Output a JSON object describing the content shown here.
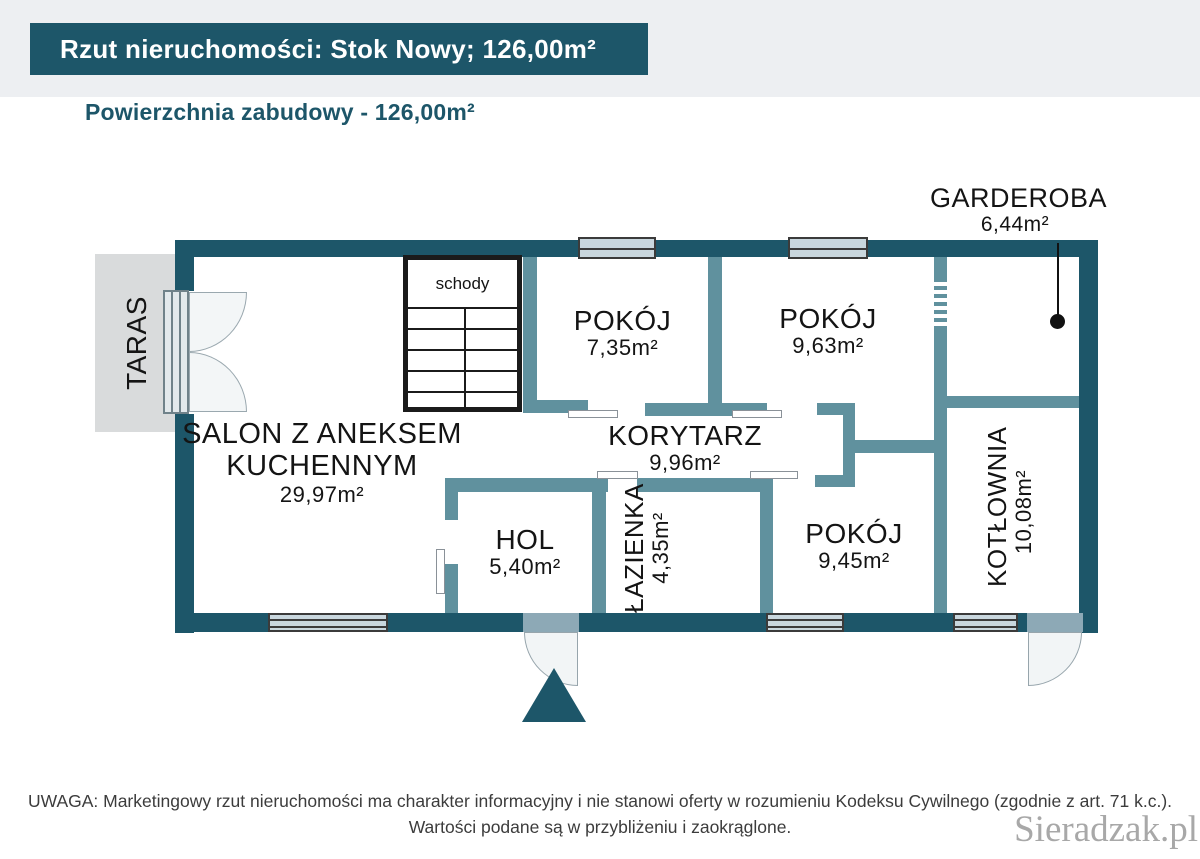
{
  "header": {
    "title": "Rzut nieruchomości: Stok Nowy; 126,00m²"
  },
  "subtitle": "Powierzchnia zabudowy - 126,00m²",
  "rooms": {
    "salon": {
      "line1": "SALON Z ANEKSEM",
      "line2": "KUCHENNYM",
      "area": "29,97m²"
    },
    "pokoj_1": {
      "name": "POKÓJ",
      "area": "7,35m²"
    },
    "pokoj_2": {
      "name": "POKÓJ",
      "area": "9,63m²"
    },
    "pokoj_3": {
      "name": "POKÓJ",
      "area": "9,45m²"
    },
    "korytarz": {
      "name": "KORYTARZ",
      "area": "9,96m²"
    },
    "hol": {
      "name": "HOL",
      "area": "5,40m²"
    },
    "lazienka": {
      "name": "ŁAZIENKA",
      "area": "4,35m²"
    },
    "kotlownia": {
      "name": "KOTŁOWNIA",
      "area": "10,08m²"
    },
    "garderoba": {
      "name": "GARDEROBA",
      "area": "6,44m²"
    },
    "taras": {
      "name": "TARAS"
    },
    "schody": {
      "name": "schody"
    }
  },
  "footer": {
    "line1": "UWAGA: Marketingowy rzut nieruchomości ma charakter informacyjny i nie stanowi oferty w rozumieniu Kodeksu Cywilnego (zgodnie z art. 71 k.c.).",
    "line2": "Wartości podane są w przybliżeniu i zaokrąglone."
  },
  "watermark": "Sieradzak.pl",
  "colors": {
    "primary_dark_teal": "#1d5669",
    "interior_wall_teal": "#60919e",
    "window_fill": "#c9d7de",
    "terrace_gray": "#d9dbdc",
    "door_leaf": "#8da9b6",
    "watermark_gray": "#a8a8a8"
  }
}
